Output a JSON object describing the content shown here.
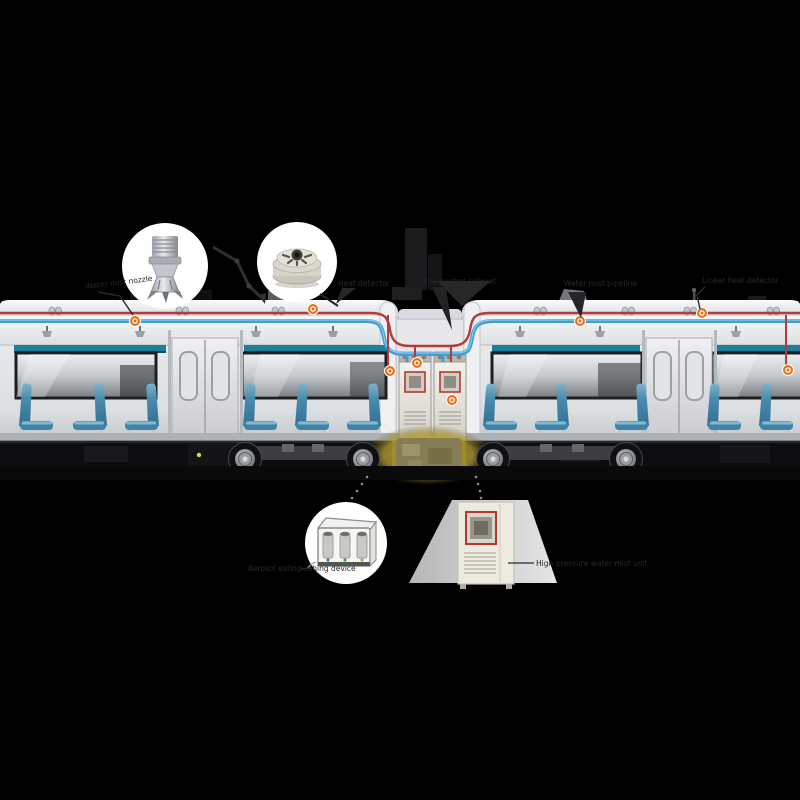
{
  "scene": {
    "background_color": "#000000",
    "subject": "metro train cutaway with fire detection and water-mist suppression system"
  },
  "labels": {
    "nozzle": "Water mist nozzle",
    "heat_detector": "Heat detector",
    "control_cabinet": "Fire control cabinet",
    "pipeline": "Water mist pipeline",
    "line_heat_detector": "Linear heat detector",
    "aerosol_unit": "Aerosol extinguishing device",
    "mist_pump_unit": "High-pressure water mist unit"
  },
  "colors": {
    "marker_orange": "#e8721b",
    "pipe_red": "#b23c3c",
    "pipe_blue": "#3d9ed6",
    "seat_blue": "#3f83a8",
    "rack_teal": "#1f7e9a",
    "underfloor_highlight": "#b89f2e",
    "cabinet_cream": "#edeae1",
    "screen_frame_red": "#b5382c"
  },
  "markers": {
    "count": 8,
    "color": "#e8721b"
  }
}
